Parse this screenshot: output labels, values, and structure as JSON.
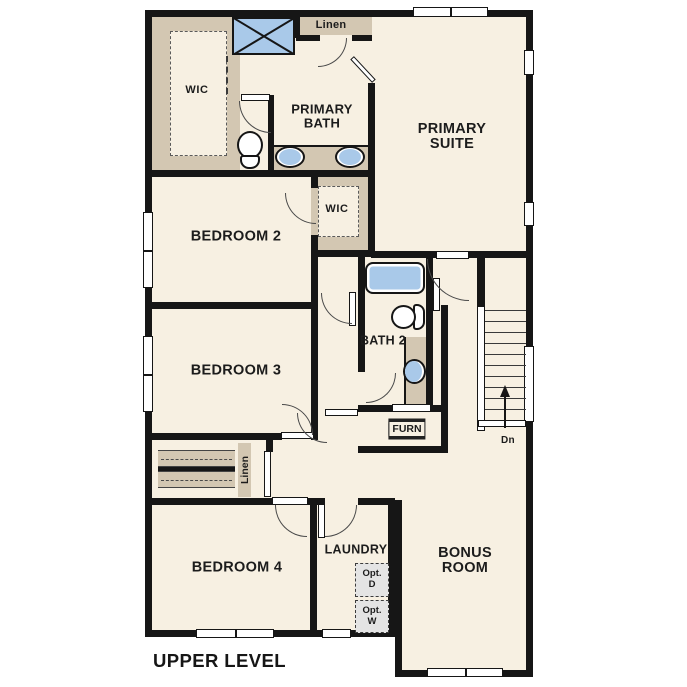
{
  "plan": {
    "title": "UPPER LEVEL",
    "stairs": {
      "direction_label": "Dn",
      "tread_count": 10
    }
  },
  "rooms": {
    "primary_suite": {
      "label": "PRIMARY SUITE"
    },
    "primary_bath": {
      "label": "PRIMARY BATH"
    },
    "primary_wic": {
      "label": "WIC"
    },
    "linen_upper": {
      "label": "Linen"
    },
    "bedroom_2": {
      "label": "BEDROOM 2"
    },
    "bedroom_2_wic": {
      "label": "WIC"
    },
    "bedroom_3": {
      "label": "BEDROOM 3"
    },
    "bath_2": {
      "label": "BATH 2"
    },
    "hall_linen": {
      "label": "Linen"
    },
    "furnace_closet": {
      "label": "FURN"
    },
    "bedroom_4": {
      "label": "BEDROOM 4"
    },
    "laundry": {
      "label": "LAUNDRY",
      "optional_dryer": {
        "line1": "Opt.",
        "line2": "D"
      },
      "optional_washer": {
        "line1": "Opt.",
        "line2": "W"
      }
    },
    "bonus_room": {
      "label": "BONUS ROOM"
    }
  },
  "colors": {
    "floor": "#f7f0e2",
    "closet_tan": "#d3c7b2",
    "fixture_blue": "#a9c9e9",
    "wall": "#161616",
    "optional_appliance_gray": "#e4e4e4"
  }
}
